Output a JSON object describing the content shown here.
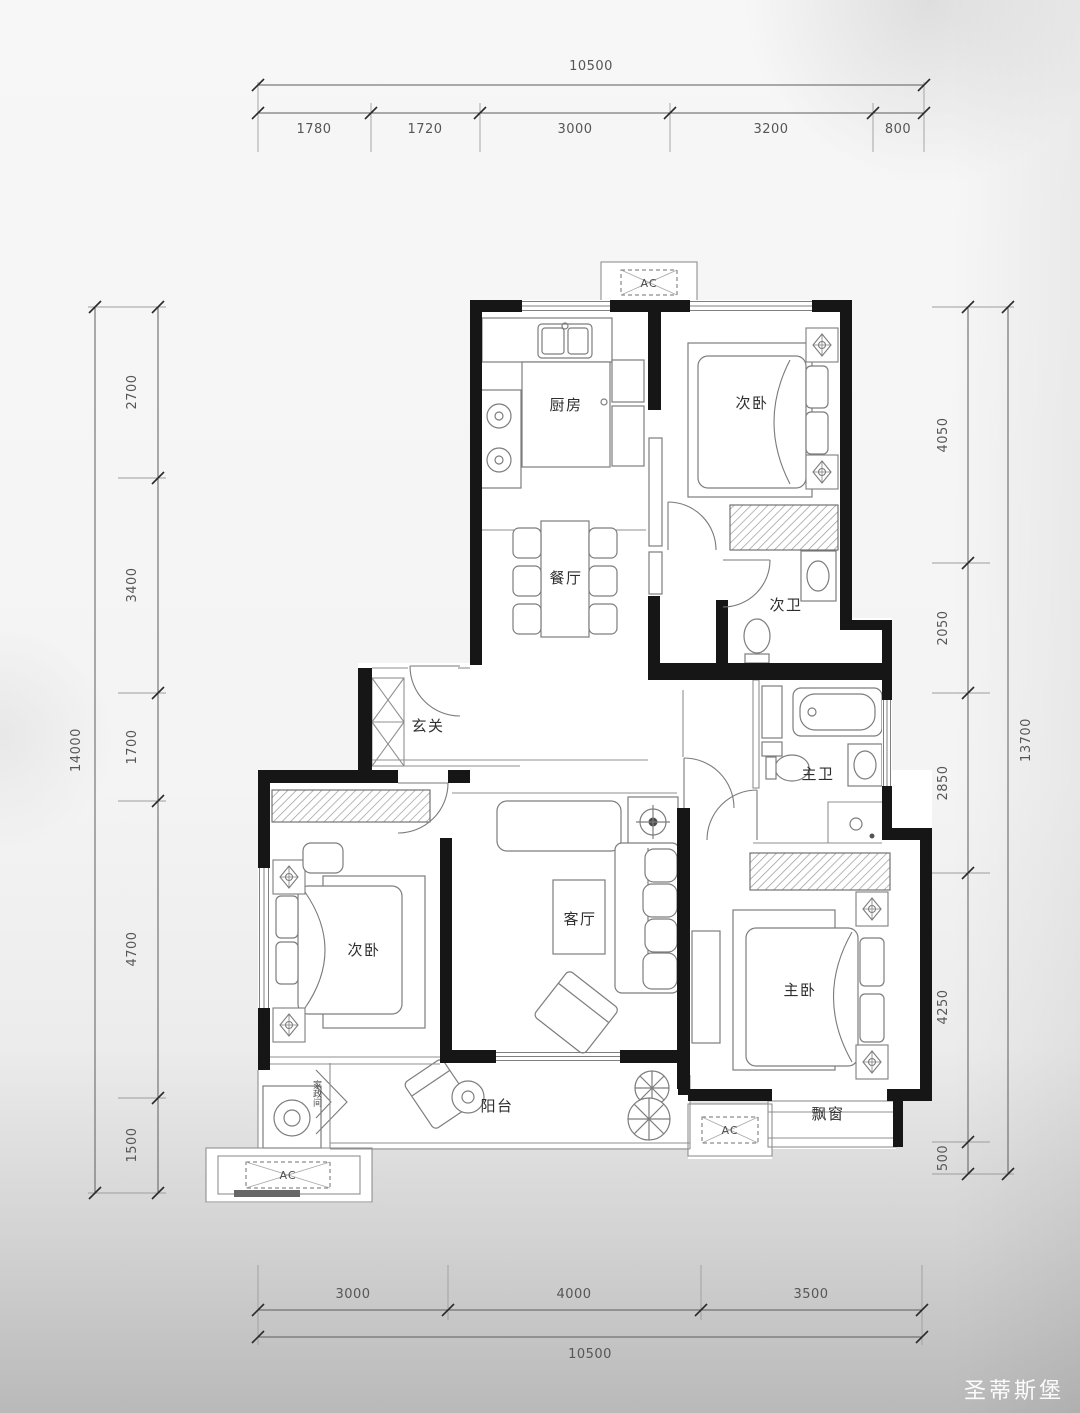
{
  "watermark": "圣蒂斯堡",
  "rooms": {
    "kitchen": "厨房",
    "bedroom_top": "次卧",
    "bath_secondary": "次卫",
    "dining": "餐厅",
    "entry": "玄关",
    "bath_master": "主卫",
    "bedroom_left": "次卧",
    "living": "客厅",
    "bedroom_master": "主卧",
    "balcony": "阳台",
    "bay_window": "飘窗",
    "utility": "家政间",
    "ac_label": "AC"
  },
  "dimensions": {
    "top": {
      "total": "10500",
      "segments": [
        "1780",
        "1720",
        "3000",
        "3200",
        "800"
      ]
    },
    "bottom": {
      "total": "10500",
      "segments": [
        "3000",
        "4000",
        "3500"
      ]
    },
    "left": {
      "total": "14000",
      "segments": [
        "2700",
        "3400",
        "1700",
        "4700",
        "1500"
      ]
    },
    "right": {
      "total": "13700",
      "segments": [
        "4050",
        "2050",
        "2850",
        "4250",
        "500"
      ]
    }
  }
}
